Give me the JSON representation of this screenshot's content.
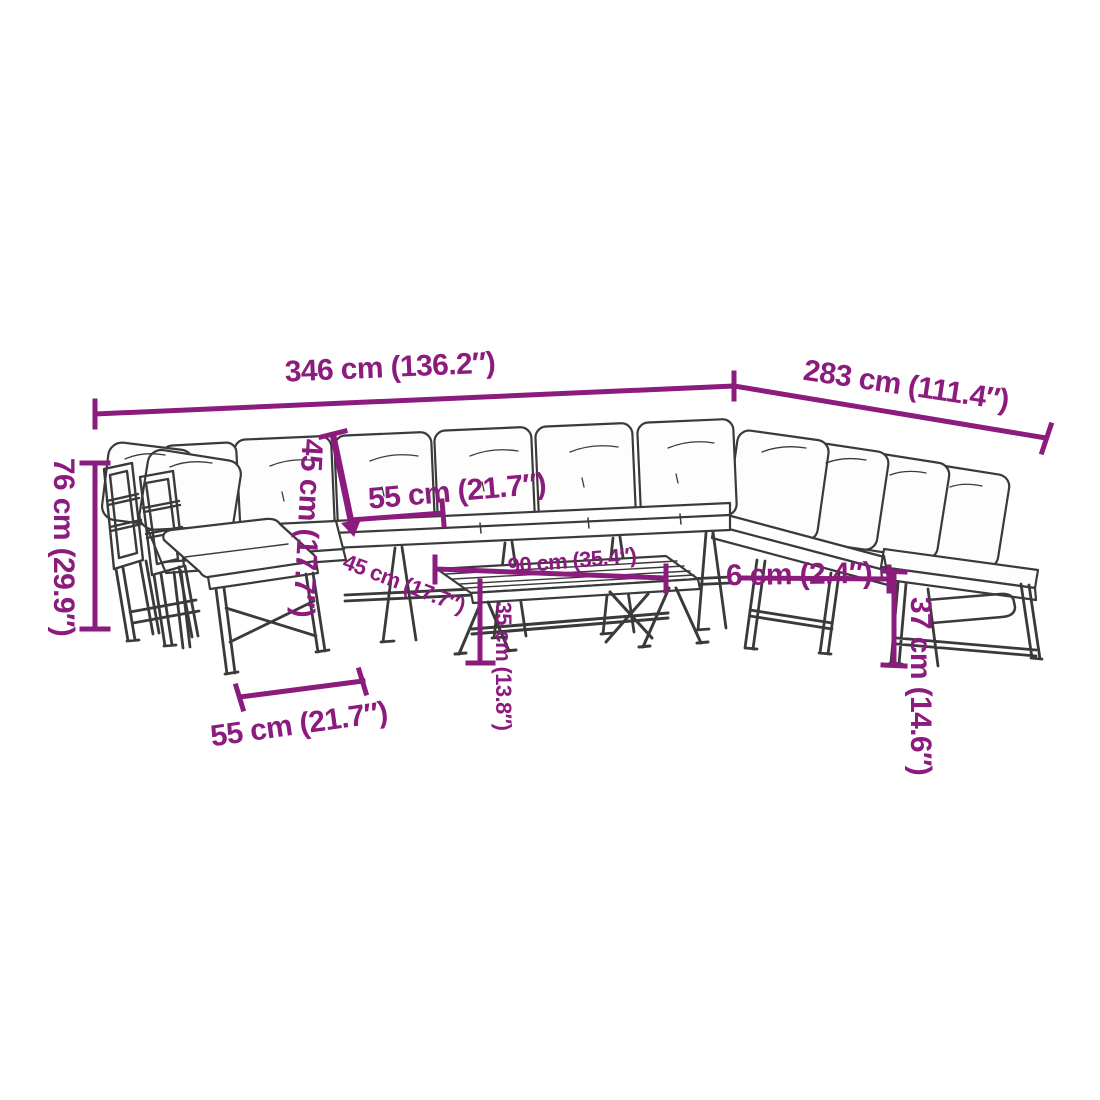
{
  "diagram": {
    "description": "Dimension diagram line drawing of a garden lounge furniture set with benches, corner chairs and a slatted coffee table",
    "background_color": "#ffffff",
    "accent_color": "#8B1B7D",
    "line_color": "#3a3a3a",
    "dimensions": [
      {
        "id": "total-width",
        "label": "346 cm (136.2″)"
      },
      {
        "id": "total-depth",
        "label": "283 cm (111.4″)"
      },
      {
        "id": "total-height",
        "label": "76 cm (29.9″)"
      },
      {
        "id": "backrest-height",
        "label": "45 cm (17.7″)"
      },
      {
        "id": "seat-width",
        "label": "55 cm (21.7″)"
      },
      {
        "id": "seat-depth",
        "label": "45 cm (17.7″)"
      },
      {
        "id": "table-length",
        "label": "90 cm (35.4″)"
      },
      {
        "id": "table-height",
        "label": "35 cm (13.8″)"
      },
      {
        "id": "cushion-thickness",
        "label": "6 cm (2.4″)"
      },
      {
        "id": "bench-seat-height",
        "label": "37 cm (14.6″)"
      },
      {
        "id": "bench-width",
        "label": "55 cm (21.7″)"
      }
    ]
  }
}
